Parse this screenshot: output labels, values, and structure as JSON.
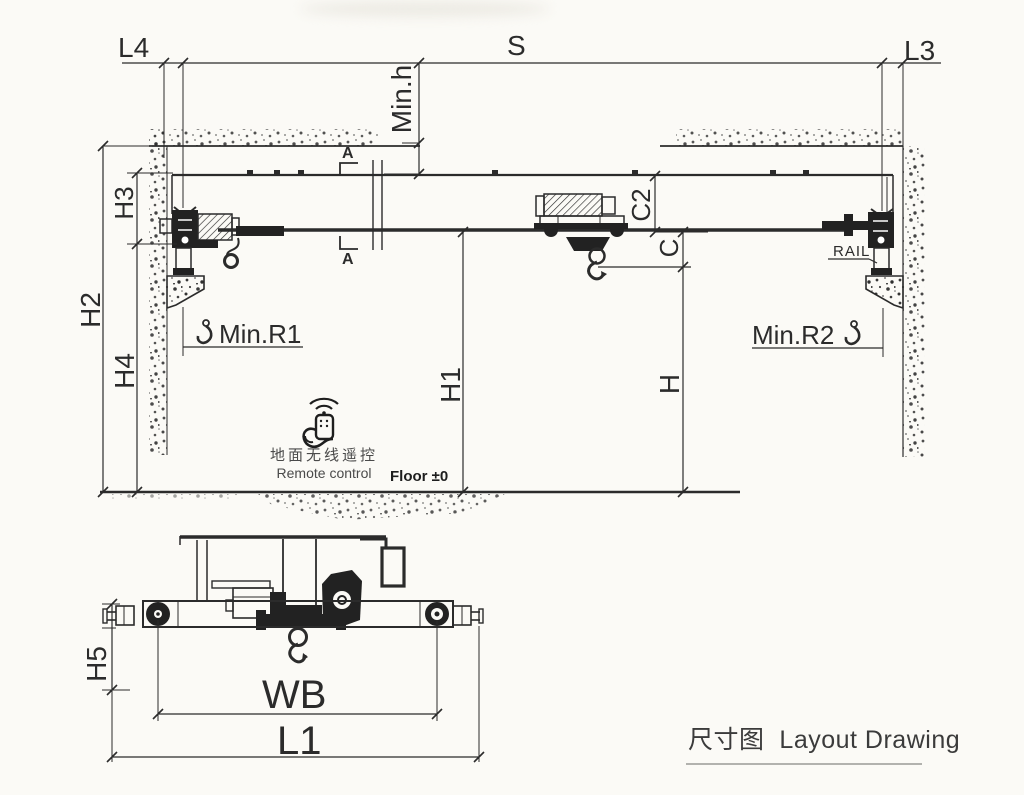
{
  "drawing": {
    "type": "crane-layout-dimension-drawing",
    "title_cn": "尺寸图",
    "title_en": "Layout Drawing",
    "labels": {
      "l4": "L4",
      "s": "S",
      "l3": "L3",
      "min_h": "Min.h",
      "h2": "H2",
      "h3": "H3",
      "h4": "H4",
      "c2": "C2",
      "c": "C",
      "h1": "H1",
      "h": "H",
      "min_r1": "Min.R1",
      "min_r2": "Min.R2",
      "rail": "RAIL",
      "section_a": "A",
      "h5": "H5",
      "wb": "WB",
      "l1": "L1"
    },
    "annotations": {
      "remote_cn": "地面无线遥控",
      "remote_en": "Remote control",
      "floor_level": "Floor ±0"
    },
    "colors": {
      "line": "#2b2b2b",
      "background": "#fbfaf6",
      "text": "#2b2b2b",
      "muted_text": "#4a4a4a",
      "title_text": "#3b3b3b"
    }
  }
}
